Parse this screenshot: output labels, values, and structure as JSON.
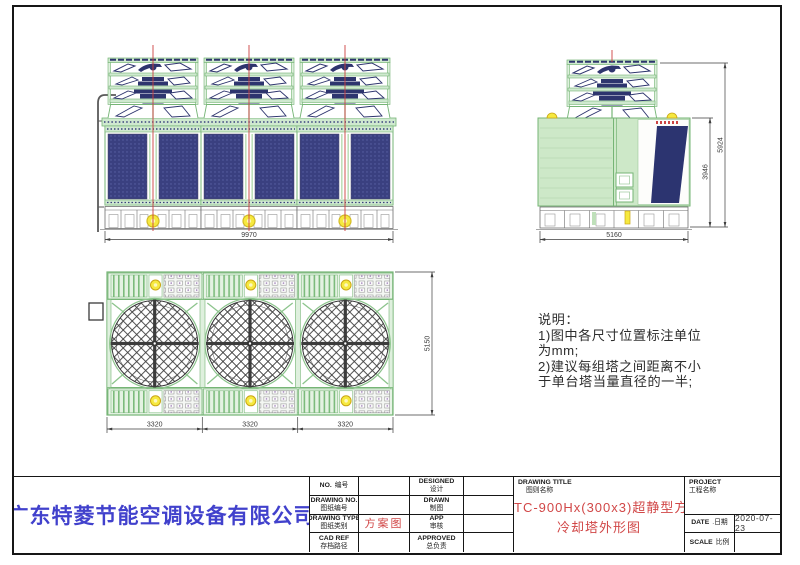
{
  "notes": {
    "lines": [
      "说明：",
      "1)图中各尺寸位置标注单位",
      "为mm;",
      "2)建议每组塔之间距离不小",
      "于单台塔当量直径的一半;"
    ]
  },
  "views": {
    "front": {
      "width": "9970"
    },
    "side": {
      "width": "5160",
      "body_height": "3946",
      "total_height": "5924"
    },
    "plan": {
      "widths": [
        "3320",
        "3320",
        "3320"
      ],
      "depth": "5150"
    }
  },
  "title_block": {
    "company": "广东特菱节能空调设备有限公司",
    "info_rows": [
      {
        "en": "NO.",
        "cn": "编号",
        "value": ""
      },
      {
        "en": "DRAWING NO.",
        "cn": "图纸编号",
        "value": ""
      },
      {
        "en": "DRAWING TYPE",
        "cn": "图纸类别",
        "value": "方案图"
      },
      {
        "en": "CAD REF",
        "cn": "存档路径",
        "value": ""
      }
    ],
    "sign_rows": [
      {
        "en": "DESIGNED",
        "cn": "设计",
        "value": ""
      },
      {
        "en": "DRAWN",
        "cn": "制图",
        "value": ""
      },
      {
        "en": "APP",
        "cn": "审核",
        "value": ""
      },
      {
        "en": "APPROVED",
        "cn": "总负责",
        "value": ""
      }
    ],
    "drawing_title": {
      "en": "DRAWING TITLE",
      "cn": "图则名称",
      "line1": "TC-900Hx(300x3)超静型方形横流式",
      "line2": "冷却塔外形图"
    },
    "project": {
      "en": "PROJECT",
      "cn": "工程名称"
    },
    "date": {
      "en": "DATE",
      "cn": ".日期",
      "value": "2020-07-23"
    },
    "scale": {
      "en": "SCALE",
      "cn": "比例",
      "value": ""
    }
  },
  "colors": {
    "frame_green": "#76b576",
    "fill_green": "#cfe9cf",
    "navy": "#2e356e",
    "accent_red": "#cc4040",
    "title_red": "#d14747",
    "company_blue": "#4141cc",
    "yellow": "#f6e93f"
  }
}
